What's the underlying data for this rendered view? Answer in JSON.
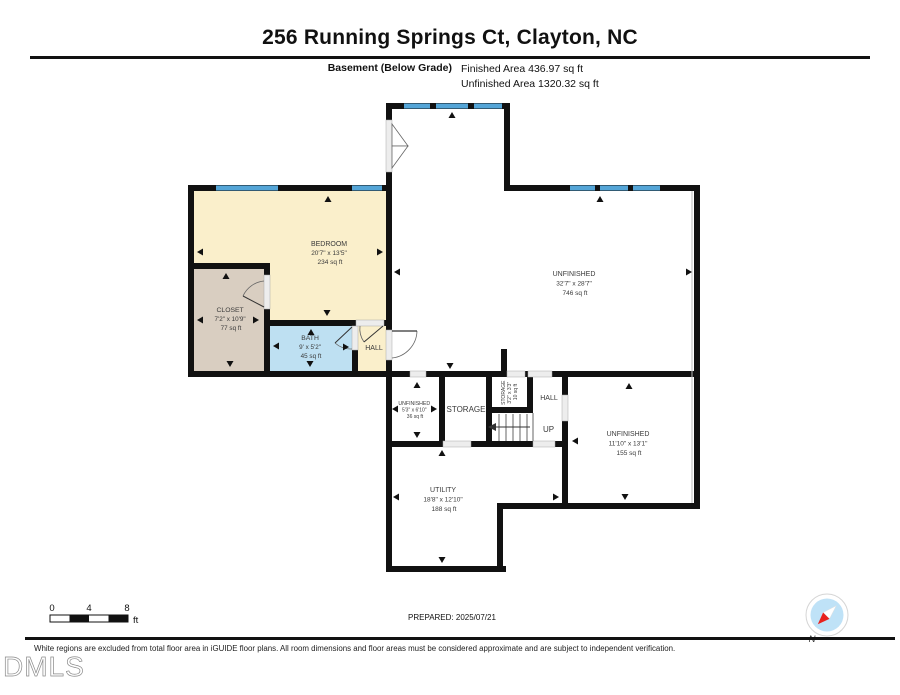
{
  "header": {
    "title": "256 Running Springs Ct, Clayton, NC",
    "floor_label": "Basement (Below Grade)",
    "finished_area": "Finished Area 436.97 sq ft",
    "unfinished_area": "Unfinished Area 1320.32 sq ft"
  },
  "rooms": {
    "bedroom": {
      "name": "BEDROOM",
      "dims": "20'7\" x 13'5\"",
      "area": "234 sq ft"
    },
    "closet": {
      "name": "CLOSET",
      "dims": "7'2\" x 10'9\"",
      "area": "77 sq ft"
    },
    "bath": {
      "name": "BATH",
      "dims": "9' x 5'2\"",
      "area": "45 sq ft"
    },
    "hall_upper": {
      "name": "HALL"
    },
    "unfinished_main": {
      "name": "UNFINISHED",
      "dims": "32'7\" x 28'7\"",
      "area": "746 sq ft"
    },
    "unfinished_small": {
      "name": "UNFINISHED",
      "dims": "5'3\" x 6'10\"",
      "area": "36 sq ft"
    },
    "storage": {
      "name": "STORAGE"
    },
    "storage_small": {
      "name": "STORAGE",
      "dims": "3'2\" x 3'3\"",
      "area": "10 sq ft"
    },
    "hall_lower": {
      "name": "HALL"
    },
    "stairs": {
      "label": "UP"
    },
    "unfinished_right": {
      "name": "UNFINISHED",
      "dims": "11'10\" x 13'1\"",
      "area": "155 sq ft"
    },
    "utility": {
      "name": "UTILITY",
      "dims": "18'8\" x 12'10\"",
      "area": "188 sq ft"
    }
  },
  "scale_bar": {
    "tick0": "0",
    "tick1": "4",
    "tick2": "8",
    "unit": "ft"
  },
  "prepared_label": "PREPARED: 2025/07/21",
  "compass": {
    "label": "N"
  },
  "footer": {
    "disclaimer": "White regions are excluded from total floor area in iGUIDE floor plans. All room dimensions and floor areas must be considered approximate and are subject to independent verification.",
    "logo": "DMLS"
  },
  "colors": {
    "finished_cream": "#FAEFCB",
    "closet_tan": "#D9CEC1",
    "bath_blue": "#BEE0F2",
    "window_blue": "#54A5D7",
    "wall_black": "#111111",
    "compass_blue": "#BFE2F7",
    "compass_red": "#E8211D"
  }
}
